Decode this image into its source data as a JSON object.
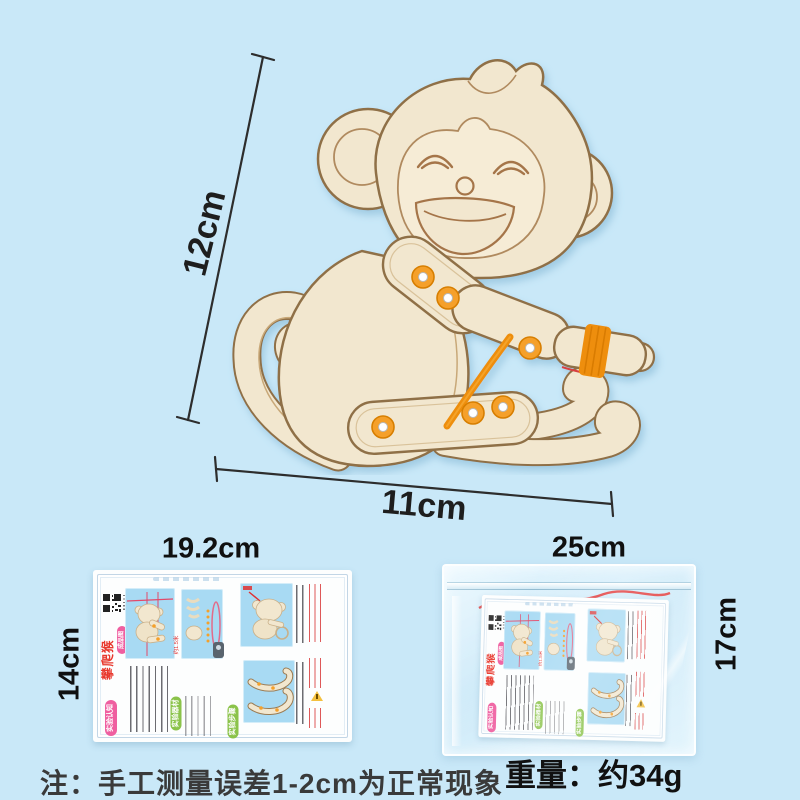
{
  "scene": {
    "background_color": "#C9E8F8",
    "note": "注：手工测量误差1-2cm为正常现象",
    "weight": "重量：约34g"
  },
  "measurements": {
    "figure_height": "12cm",
    "figure_width": "11cm",
    "card_width": "19.2cm",
    "card_height": "14cm",
    "bag_width": "25cm",
    "bag_height": "17cm"
  },
  "figure": {
    "subject": "wooden-climbing-monkey-kit",
    "wood_color": "#F2E7CF",
    "outline_color": "#8F6F46",
    "rivet_color": "#F5A02A",
    "band_color": "#EE8E0B"
  },
  "card": {
    "title": "攀爬猴",
    "badge": "成品图",
    "sections": {
      "cognition": "实验认知",
      "materials": "实验器材",
      "steps": "实验步骤"
    },
    "band_note": "约1.5米",
    "title_color": "#E8382D",
    "badge_color": "#EF5FA0",
    "section_green": "#8BC34A",
    "panel_color": "#A8DAF3"
  }
}
